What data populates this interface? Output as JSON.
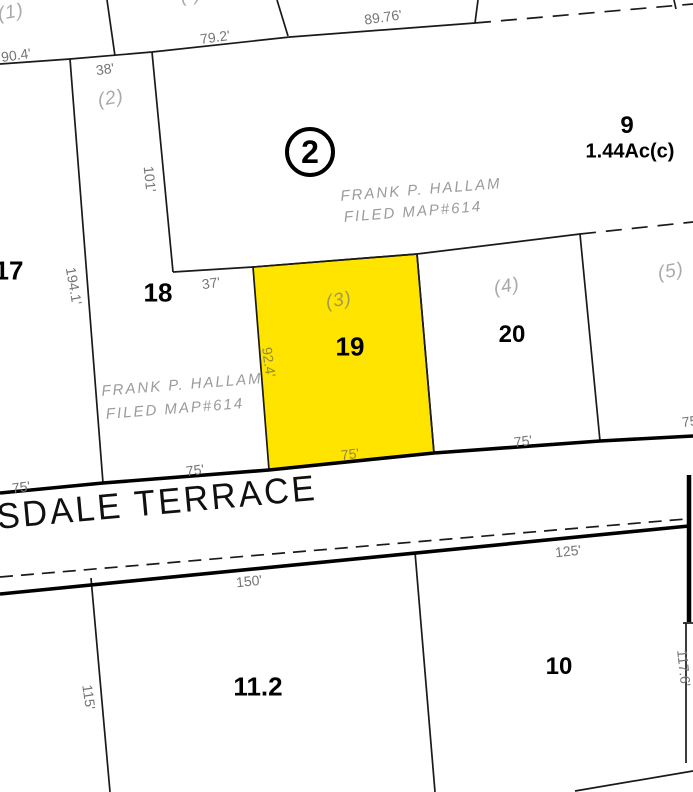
{
  "map": {
    "street_name": "SDALE TERRACE",
    "block_badge": "2",
    "highlight_color": "#ffe400",
    "line_color": "#1a1a1a",
    "parcels": [
      {
        "id": "9",
        "area": "1.44Ac(c)"
      },
      {
        "id": "17"
      },
      {
        "id": "18"
      },
      {
        "id": "19",
        "highlighted": true
      },
      {
        "id": "20"
      },
      {
        "id": "11.2"
      },
      {
        "id": "10"
      }
    ],
    "lot_refs": [
      "(1)",
      "(2)",
      "(3)",
      "(4)",
      "(5)"
    ],
    "partial_lot_ref": "( )",
    "owner_note": {
      "line1": "FRANK P. HALLAM",
      "line2": "FILED MAP#614"
    },
    "dimensions": {
      "d904": "90.4'",
      "d792": "79.2'",
      "d8976": "89.76'",
      "d38": "38'",
      "d101": "101'",
      "d1941": "194.1'",
      "d37": "37'",
      "d924": "92.4'",
      "d75": "75'",
      "d150": "150'",
      "d125": "125'",
      "d115": "115'",
      "d1176": "117.6'"
    }
  }
}
